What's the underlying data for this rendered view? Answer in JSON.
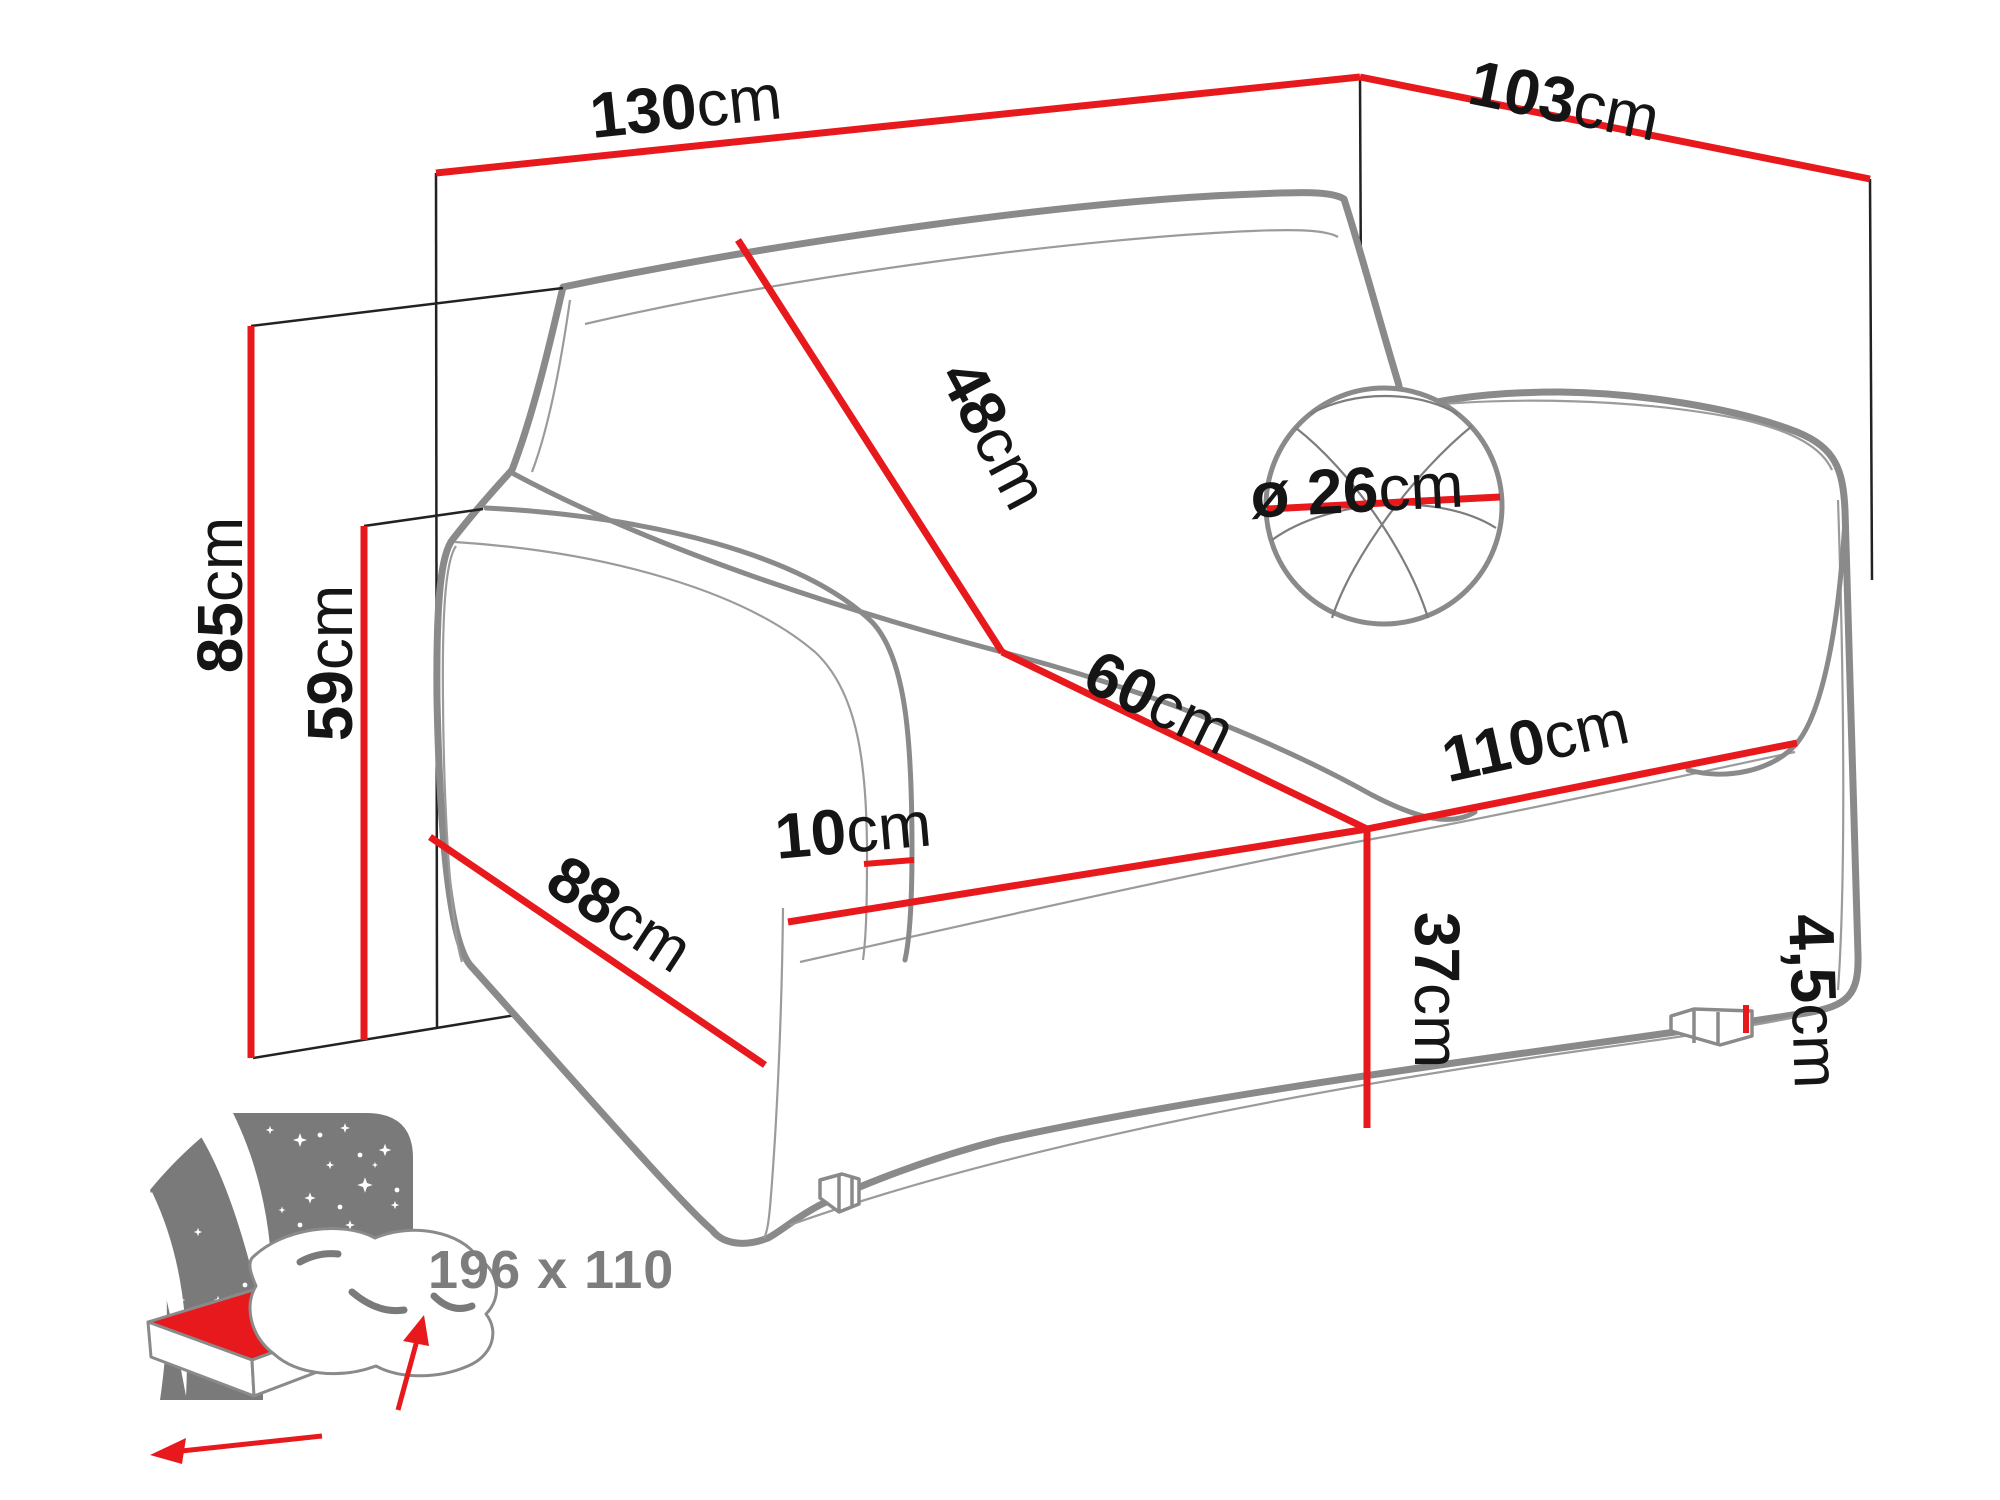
{
  "diagram": {
    "type": "sofa-bed-dimension-diagram",
    "accent_color": "#e8191d",
    "outline_color": "#8a8a8a",
    "text_color": "#151515",
    "measurements": {
      "total_width": {
        "value": "130",
        "unit": "cm"
      },
      "total_depth": {
        "value": "103",
        "unit": "cm"
      },
      "total_height": {
        "value": "85",
        "unit": "cm"
      },
      "armrest_height": {
        "value": "59",
        "unit": "cm"
      },
      "backrest_height": {
        "value": "48",
        "unit": "cm"
      },
      "cushion_diameter": {
        "value": "ø 26",
        "unit": "cm"
      },
      "seat_depth": {
        "value": "60",
        "unit": "cm"
      },
      "seat_width": {
        "value": "110",
        "unit": "cm"
      },
      "seat_height": {
        "value": "37",
        "unit": "cm"
      },
      "side_depth": {
        "value": "88",
        "unit": "cm"
      },
      "armrest_width": {
        "value": "10",
        "unit": "cm"
      },
      "leg_height": {
        "value": "4,5",
        "unit": "cm"
      }
    },
    "sleeping_area": {
      "label": "196 x 110"
    }
  }
}
